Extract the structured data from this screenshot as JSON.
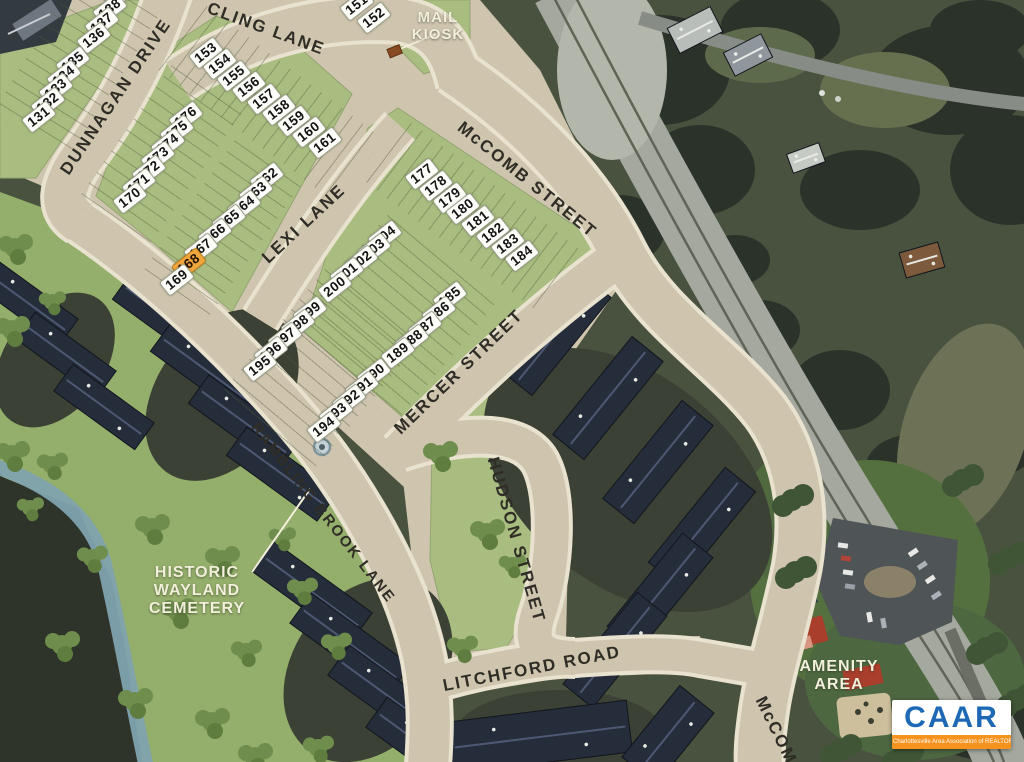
{
  "streets": [
    {
      "id": "dunnagan-drive",
      "label": "DUNNAGAN DRIVE",
      "x": 116,
      "y": 97,
      "rot": -56,
      "size": 17
    },
    {
      "id": "cling-lane",
      "label": "CLING LANE",
      "x": 266,
      "y": 29,
      "rot": 20,
      "size": 17
    },
    {
      "id": "mccomb-street",
      "label": "McCOMB STREET",
      "x": 527,
      "y": 180,
      "rot": 39,
      "size": 17
    },
    {
      "id": "lexi-lane",
      "label": "LEXI LANE",
      "x": 304,
      "y": 224,
      "rot": -43,
      "size": 17
    },
    {
      "id": "mercer-street",
      "label": "MERCER STREET",
      "x": 459,
      "y": 372,
      "rot": -44,
      "size": 17
    },
    {
      "id": "hudson-street",
      "label": "HUDSON STREET",
      "x": 516,
      "y": 540,
      "rot": 74,
      "size": 17
    },
    {
      "id": "litchford-road",
      "label": "LITCHFORD ROAD",
      "x": 532,
      "y": 669,
      "rot": -11,
      "size": 17
    },
    {
      "id": "rambling-brook-lane",
      "label": "RAMBLING BROOK LANE",
      "x": 323,
      "y": 513,
      "rot": 52,
      "size": 15
    },
    {
      "id": "mccomb-street-south",
      "label": "McCOMB",
      "x": 779,
      "y": 737,
      "rot": 64,
      "size": 17
    }
  ],
  "poi_labels": [
    {
      "id": "mail-kiosk",
      "lines": [
        "MAIL",
        "KIOSK"
      ],
      "x": 438,
      "y": 27,
      "size": 15
    },
    {
      "id": "historic-wayland-cemetery",
      "lines": [
        "HISTORIC",
        "WAYLAND",
        "CEMETERY"
      ],
      "x": 197,
      "y": 591,
      "size": 16
    },
    {
      "id": "amenity-area",
      "lines": [
        "AMENITY",
        "AREA"
      ],
      "x": 839,
      "y": 676,
      "size": 16
    }
  ],
  "lots": [
    {
      "n": "139",
      "x": 120,
      "y": -6
    },
    {
      "n": "138",
      "x": 110,
      "y": 9
    },
    {
      "n": "137",
      "x": 102,
      "y": 23
    },
    {
      "n": "136",
      "x": 94,
      "y": 38
    },
    {
      "n": "135",
      "x": 73,
      "y": 62
    },
    {
      "n": "134",
      "x": 64,
      "y": 76
    },
    {
      "n": "133",
      "x": 56,
      "y": 89
    },
    {
      "n": "132",
      "x": 48,
      "y": 103
    },
    {
      "n": "131",
      "x": 39,
      "y": 117
    },
    {
      "n": "151",
      "x": 357,
      "y": 5
    },
    {
      "n": "152",
      "x": 374,
      "y": 18
    },
    {
      "n": "153",
      "x": 206,
      "y": 53
    },
    {
      "n": "154",
      "x": 220,
      "y": 64
    },
    {
      "n": "155",
      "x": 234,
      "y": 76
    },
    {
      "n": "156",
      "x": 249,
      "y": 87
    },
    {
      "n": "157",
      "x": 264,
      "y": 99
    },
    {
      "n": "158",
      "x": 279,
      "y": 110
    },
    {
      "n": "159",
      "x": 294,
      "y": 121
    },
    {
      "n": "160",
      "x": 309,
      "y": 132
    },
    {
      "n": "161",
      "x": 325,
      "y": 143
    },
    {
      "n": "176",
      "x": 186,
      "y": 117
    },
    {
      "n": "175",
      "x": 177,
      "y": 131
    },
    {
      "n": "174",
      "x": 168,
      "y": 144
    },
    {
      "n": "173",
      "x": 158,
      "y": 157
    },
    {
      "n": "172",
      "x": 149,
      "y": 171
    },
    {
      "n": "171",
      "x": 139,
      "y": 184
    },
    {
      "n": "170",
      "x": 130,
      "y": 198
    },
    {
      "n": "162",
      "x": 267,
      "y": 178
    },
    {
      "n": "163",
      "x": 256,
      "y": 192
    },
    {
      "n": "164",
      "x": 244,
      "y": 206
    },
    {
      "n": "165",
      "x": 229,
      "y": 220
    },
    {
      "n": "166",
      "x": 215,
      "y": 234
    },
    {
      "n": "167",
      "x": 201,
      "y": 249
    },
    {
      "n": "168",
      "x": 189,
      "y": 264,
      "hl": true
    },
    {
      "n": "169",
      "x": 177,
      "y": 280
    },
    {
      "n": "177",
      "x": 422,
      "y": 174
    },
    {
      "n": "178",
      "x": 436,
      "y": 186
    },
    {
      "n": "179",
      "x": 450,
      "y": 198
    },
    {
      "n": "180",
      "x": 463,
      "y": 209
    },
    {
      "n": "181",
      "x": 478,
      "y": 221
    },
    {
      "n": "182",
      "x": 493,
      "y": 233
    },
    {
      "n": "183",
      "x": 508,
      "y": 244
    },
    {
      "n": "184",
      "x": 522,
      "y": 256
    },
    {
      "n": "204",
      "x": 385,
      "y": 236
    },
    {
      "n": "203",
      "x": 374,
      "y": 249
    },
    {
      "n": "202",
      "x": 361,
      "y": 261
    },
    {
      "n": "201",
      "x": 347,
      "y": 273
    },
    {
      "n": "200",
      "x": 335,
      "y": 287
    },
    {
      "n": "185",
      "x": 450,
      "y": 297
    },
    {
      "n": "186",
      "x": 439,
      "y": 312
    },
    {
      "n": "187",
      "x": 425,
      "y": 327
    },
    {
      "n": "188",
      "x": 412,
      "y": 340
    },
    {
      "n": "189",
      "x": 398,
      "y": 353
    },
    {
      "n": "199",
      "x": 310,
      "y": 312
    },
    {
      "n": "198",
      "x": 298,
      "y": 325
    },
    {
      "n": "197",
      "x": 285,
      "y": 338
    },
    {
      "n": "196",
      "x": 271,
      "y": 352
    },
    {
      "n": "195",
      "x": 260,
      "y": 366
    },
    {
      "n": "190",
      "x": 374,
      "y": 374
    },
    {
      "n": "191",
      "x": 362,
      "y": 387
    },
    {
      "n": "192",
      "x": 349,
      "y": 400
    },
    {
      "n": "193",
      "x": 336,
      "y": 413
    },
    {
      "n": "194",
      "x": 324,
      "y": 427
    }
  ],
  "highlight_color": "#efa63d",
  "logo": {
    "text": "CAAR",
    "tagline": "Charlottesville Area Association of REALTORS®"
  }
}
